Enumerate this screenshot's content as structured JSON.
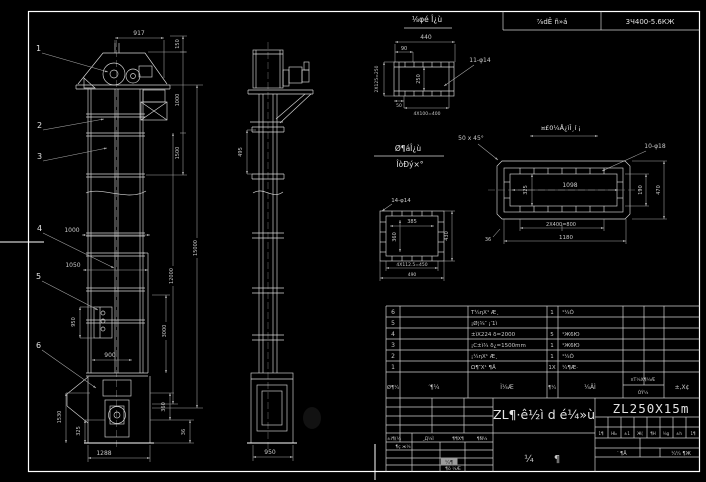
{
  "sheet": {
    "bg": "#000000",
    "line_color": "#ffffff",
    "top_table": {
      "cell1": "⅞dÊ ñ»á",
      "cell2": "3Ч400-5.6КЖ"
    }
  },
  "front_view": {
    "callouts": [
      "1",
      "2",
      "3",
      "4",
      "5",
      "6"
    ],
    "dims": {
      "d917": "917",
      "d150": "150",
      "d1000r": "1000",
      "d1500": "1500",
      "d15000": "15000",
      "d12000": "12000",
      "d3000": "3000",
      "d1000l": "1000",
      "d1050": "1050",
      "d950": "950",
      "d900": "900",
      "d1530": "1530",
      "d325": "325",
      "d360": "360",
      "d36": "36",
      "d1288": "1288"
    }
  },
  "side_view": {
    "dims": {
      "d495": "495",
      "d950": "950"
    }
  },
  "detail_a": {
    "title": "⅛φé Î¿ù",
    "dims": {
      "d440": "440",
      "d90": "90",
      "d50": "50",
      "d2x125": "2Х125=250",
      "d250": "250",
      "d4x100": "4Х100=400"
    },
    "note_holes": "11-φ14"
  },
  "detail_b": {
    "title": "¤£0¼Å¿ìÎ¸í ¡",
    "note_chamfer": "50 x 45°",
    "note_holes": "10-φ18",
    "dims": {
      "d1098": "1098",
      "d325": "325",
      "d190": "190",
      "d470": "470",
      "d2x400": "2Х400=800",
      "d1180": "1180",
      "d36": "36"
    }
  },
  "detail_c": {
    "note_holes": "14-φ14",
    "dims": {
      "d385": "385",
      "d360": "360",
      "d430": "430",
      "d4x112": "4Х112.5=450",
      "d490": "490"
    }
  },
  "section_label": {
    "line1": "Ø¶áÎ¿ù",
    "line2": "ÎòÐý×°"
  },
  "bom": {
    "header": {
      "no": "Ø¶¼",
      "dwg": "′¶¼",
      "name": "Ì¼Æ",
      "qty": "¶¼",
      "mat": "¼ÄÌ",
      "weight_top": "¤Т¼Х¶¼Æ",
      "weight_bot": "ÓÝ¼",
      "remark": "±,Х¢"
    },
    "rows": [
      {
        "no": "6",
        "name": "Τ¼ηХ¹ Æ¸",
        "qty": "1",
        "mat": "¹¼Ó"
      },
      {
        "no": "5",
        "name": "¡Ø¦­¾″ ¡′1ì",
        "qty": "",
        "mat": ""
      },
      {
        "no": "4",
        "name": "±ìХ224 δ=2000",
        "qty": "5",
        "mat": "¹Ж6Ю"
      },
      {
        "no": "3",
        "name": "¡C±ì¾ δ¿=1500mm",
        "qty": "1",
        "mat": "¹Ж6Ю"
      },
      {
        "no": "2",
        "name": "¡¼ηХ¹ Æ¸",
        "qty": "1",
        "mat": "¹¼Ó"
      },
      {
        "no": "1",
        "name": "Ω¶″Х¹ ¶Ä",
        "qty": "1Х",
        "mat": "¼¶Æ·"
      }
    ]
  },
  "title_block": {
    "drawing_title": "ZL¶·ê½ì d é¼»ù",
    "model": "ZL250X15m",
    "stamp_left": "¼",
    "stamp_right": "¶",
    "rev_headers": [
      "±ì¶(¼",
      "¸Д¼Ì",
      "¶¶Х¶",
      "¶Ñ¼"
    ],
    "rev_note": "¶ç ж¼",
    "highlight_cell": "¼¶",
    "small_note": "¶ö ¼Æ",
    "info_headers": [
      "1¶",
      "НЬ",
      "±1",
      "Ж(",
      "¶Н",
      "¼g",
      "±h",
      "1¶"
    ],
    "sheets_label1": "′ ¶Ä",
    "sheets_label2": "¼¼ ¶Ж"
  }
}
